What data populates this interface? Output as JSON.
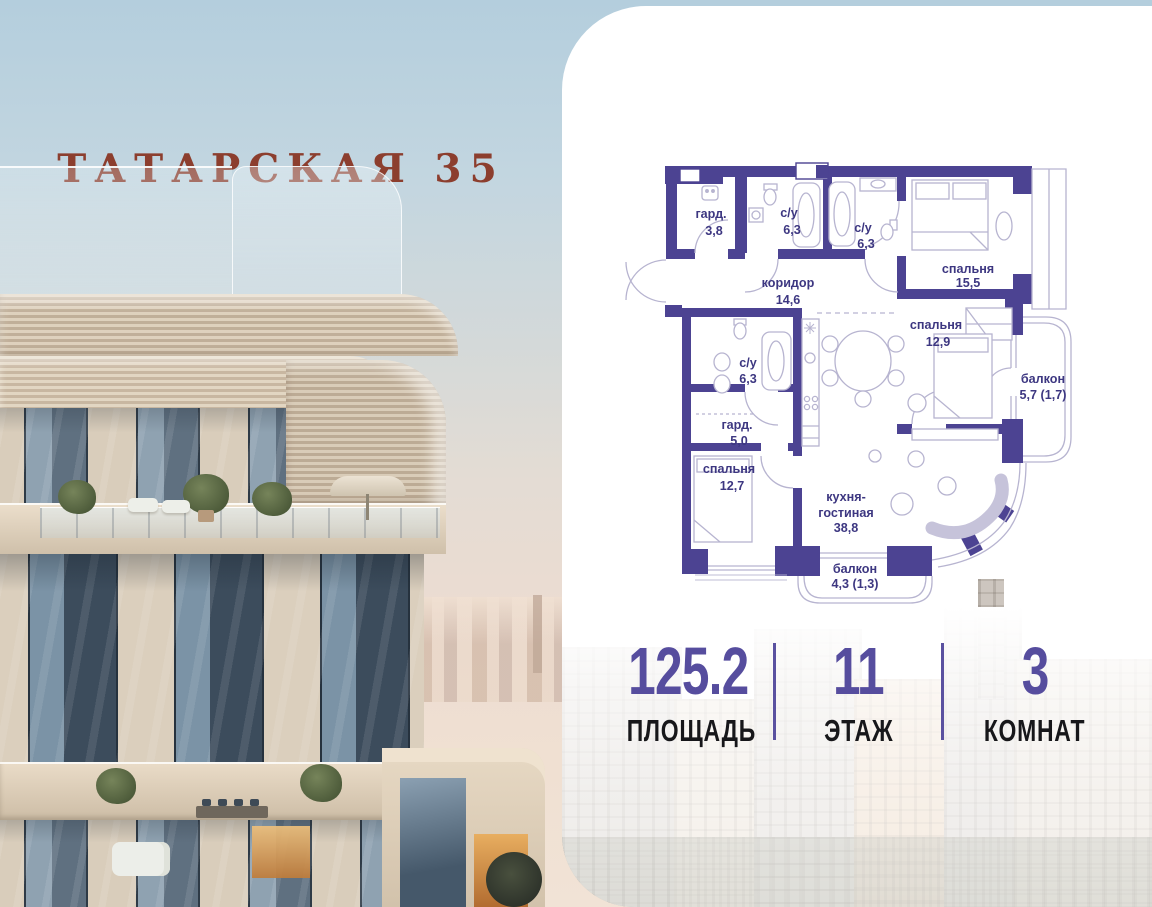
{
  "title": "ТАТАРСКАЯ 35",
  "floor_plan": {
    "rooms": {
      "wardrobe_top": {
        "name": "гард.",
        "area": "3,8"
      },
      "bath_top_1": {
        "name": "с/у",
        "area": "6,3"
      },
      "bath_top_2": {
        "name": "с/у",
        "area": "6,3"
      },
      "bedroom_top": {
        "name": "спальня",
        "area": "15,5"
      },
      "corridor": {
        "name": "коридор",
        "area": "14,6"
      },
      "bedroom_mid": {
        "name": "спальня",
        "area": "12,9"
      },
      "balcony_right": {
        "name": "балкон",
        "area": "5,7 (1,7)"
      },
      "bath_low": {
        "name": "с/у",
        "area": "6,3"
      },
      "wardrobe_low": {
        "name": "гард.",
        "area": "5,0"
      },
      "bedroom_low": {
        "name": "спальня",
        "area": "12,7"
      },
      "kitchen_living": {
        "name_line1": "кухня-",
        "name_line2": "гостиная",
        "area": "38,8"
      },
      "balcony_bottom": {
        "name": "балкон",
        "area": "4,3 (1,3)"
      }
    }
  },
  "stats": {
    "area": {
      "value": "125.2",
      "label": "ПЛОЩАДЬ"
    },
    "floor": {
      "value": "11",
      "label": "ЭТАЖ"
    },
    "rooms": {
      "value": "3",
      "label": "КОМНАТ"
    }
  },
  "colors": {
    "plan_wall": "#4c4392",
    "plan_line": "#b7b4d0",
    "plan_label": "#3d3781",
    "stat_accent": "#564d9e",
    "title_color": "#8c3e2e"
  }
}
